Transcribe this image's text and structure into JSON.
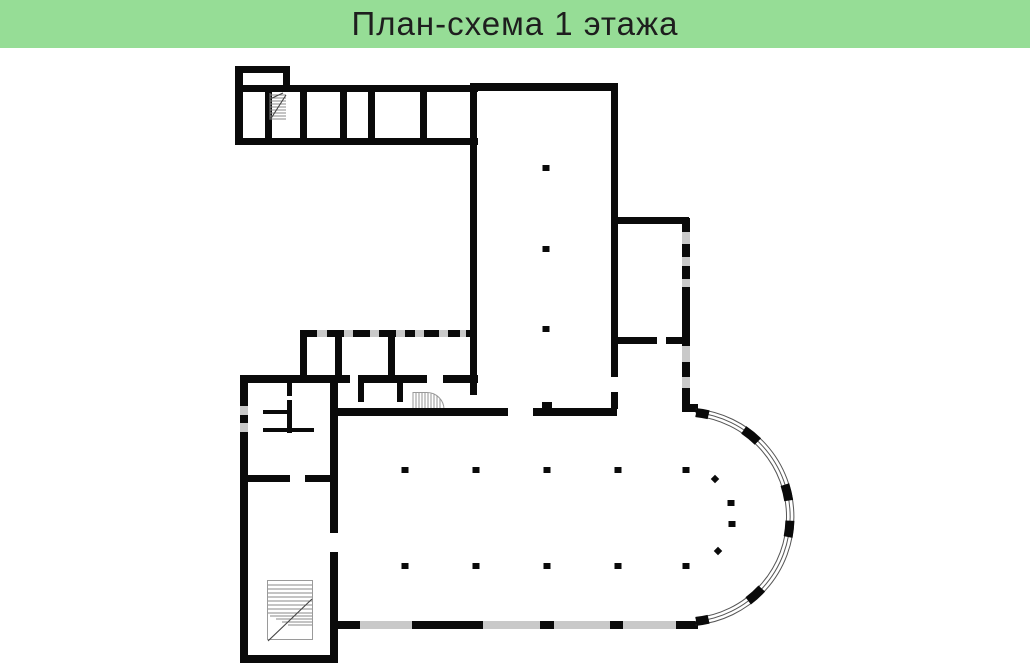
{
  "header": {
    "title": "План-схема 1 этажа",
    "background": "#96DD96",
    "text_color": "#1e1e1e"
  },
  "floorplan": {
    "wall_color": "#0a0a0a",
    "window_color": "#c9c9c9",
    "detail_color": "#8a8a8a",
    "background": "#ffffff",
    "columns": [
      {
        "x": 546,
        "y": 168
      },
      {
        "x": 546,
        "y": 249
      },
      {
        "x": 546,
        "y": 329
      },
      {
        "x": 405,
        "y": 470
      },
      {
        "x": 476,
        "y": 470
      },
      {
        "x": 547,
        "y": 470
      },
      {
        "x": 618,
        "y": 470
      },
      {
        "x": 686,
        "y": 470
      },
      {
        "x": 405,
        "y": 566
      },
      {
        "x": 476,
        "y": 566
      },
      {
        "x": 547,
        "y": 566
      },
      {
        "x": 618,
        "y": 566
      },
      {
        "x": 686,
        "y": 566
      },
      {
        "x": 715,
        "y": 479,
        "shape": "diamond"
      },
      {
        "x": 731,
        "y": 503
      },
      {
        "x": 732,
        "y": 524
      },
      {
        "x": 718,
        "y": 551,
        "shape": "diamond"
      }
    ]
  }
}
